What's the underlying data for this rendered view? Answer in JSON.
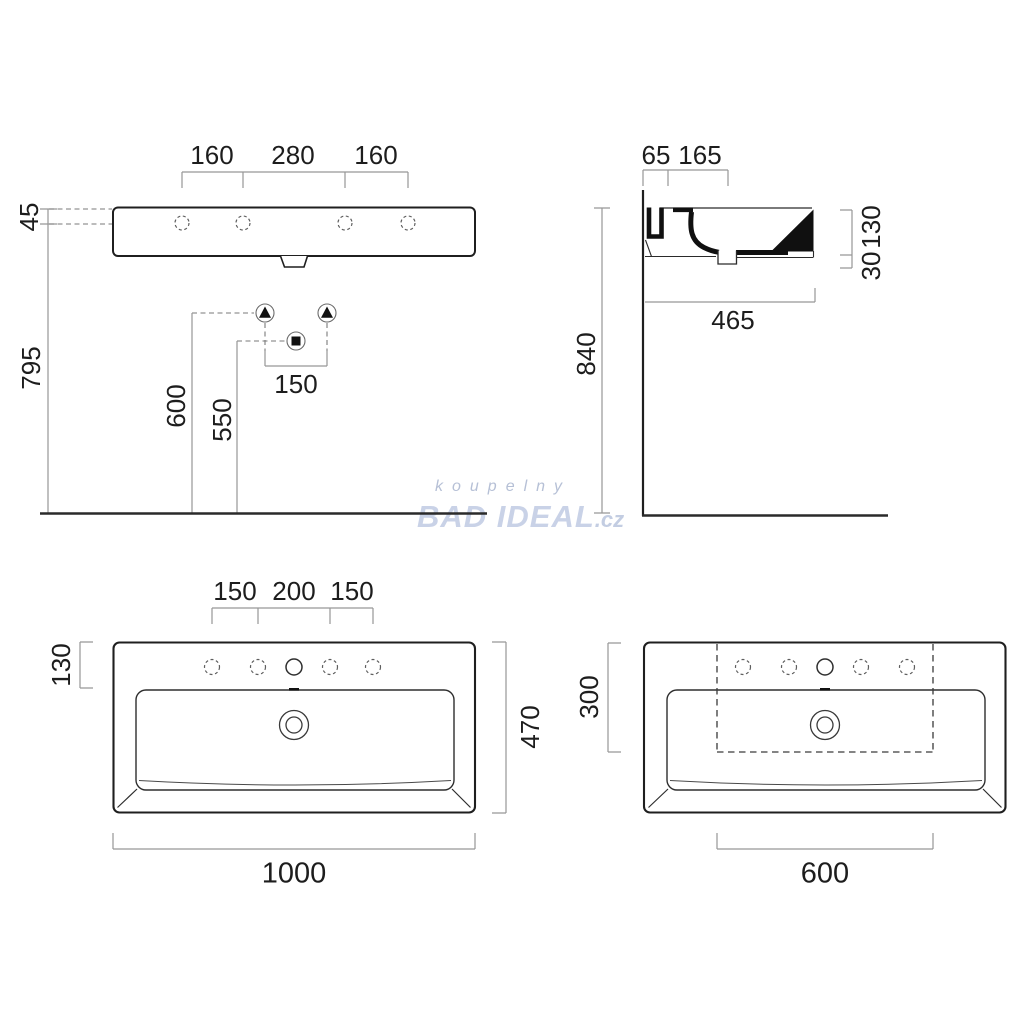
{
  "front_view": {
    "hole_pitch": [
      "160",
      "280",
      "160"
    ],
    "top_to_hole": "45",
    "mount_height": "795",
    "bracket_height": "600",
    "drain_height": "550",
    "bracket_pitch": "150"
  },
  "side_view": {
    "edge_to_hole": "65",
    "hole_to_back": "165",
    "body_height": "130",
    "drain_drop": "30",
    "depth": "465",
    "rim_height": "840"
  },
  "plan_view": {
    "hole_pitch": [
      "150",
      "200",
      "150"
    ],
    "back_ledge": "130",
    "depth": "470",
    "width": "1000"
  },
  "cabinet_view": {
    "cabinet_depth": "300",
    "cabinet_width": "600"
  },
  "watermark": {
    "tagline": "koupelny",
    "brand": "BAD IDEAL",
    "tld": ".cz"
  },
  "colors": {
    "ink": "#1f1f1f",
    "dimension_lines": "#979797",
    "dashed_lines": "#7a7a7a",
    "watermark_brand": "#c9d2e7",
    "watermark_tagline": "#b6c0d6"
  }
}
